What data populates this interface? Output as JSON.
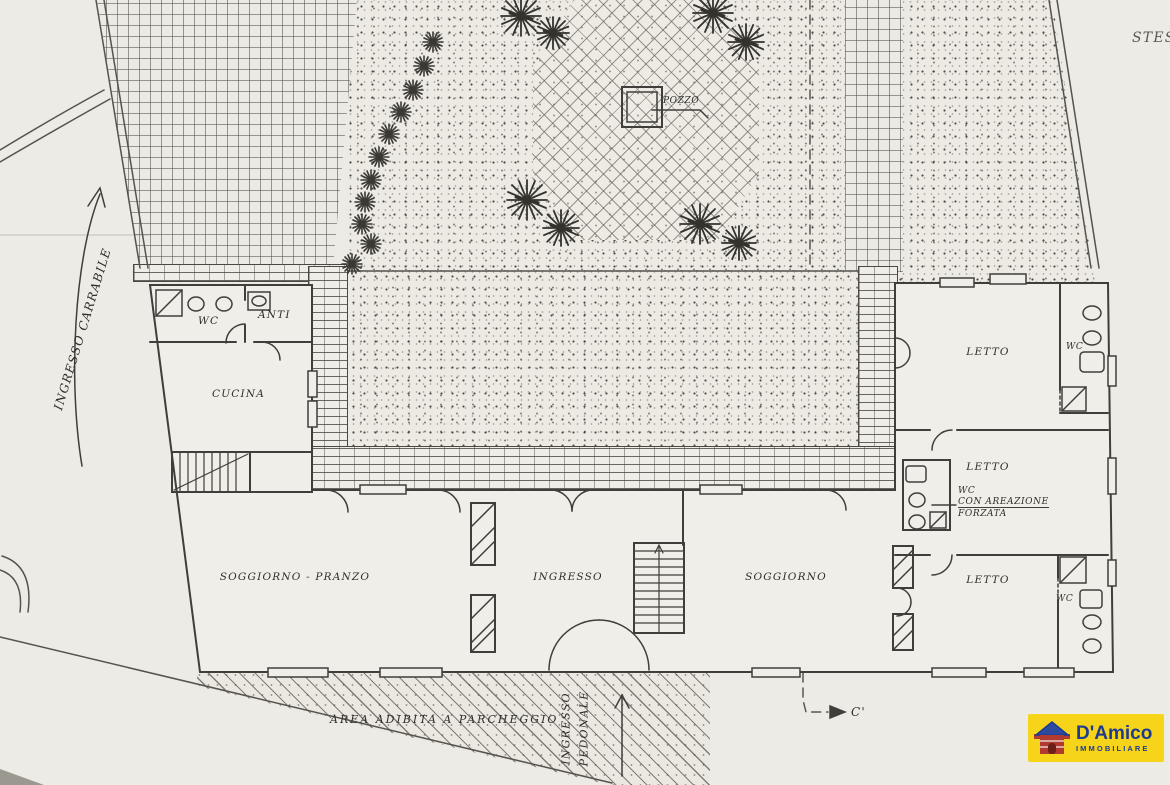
{
  "plan": {
    "stess": "STESS",
    "driveway": "INGRESSO CARRABILE",
    "well": "POZZO",
    "rooms": {
      "wc_service": "WC",
      "anti": "ANTI",
      "cucina": "CUCINA",
      "soggiorno_pranzo": "SOGGIORNO - PRANZO",
      "ingresso": "INGRESSO",
      "soggiorno": "SOGGIORNO",
      "letto_top": "LETTO",
      "wc_top": "WC",
      "letto_mid": "LETTO",
      "wc_mid_1": "WC",
      "wc_mid_2": "CON AREAZIONE",
      "wc_mid_3": "FORZATA",
      "letto_bottom": "LETTO",
      "wc_bottom": "WC"
    },
    "parking": "AREA ADIBITA A PARCHEGGIO",
    "pedestrian_1": "INGRESSO",
    "pedestrian_2": "PEDONALE",
    "section_c": "C'"
  },
  "logo": {
    "brand": "D'Amico",
    "subtitle": "IMMOBILIARE"
  },
  "colors": {
    "paper": "#edebe5",
    "ink": "#3f3e3a",
    "logo_bg": "#f6d41a",
    "logo_blue": "#1d3c8f",
    "logo_red": "#b13a31"
  }
}
